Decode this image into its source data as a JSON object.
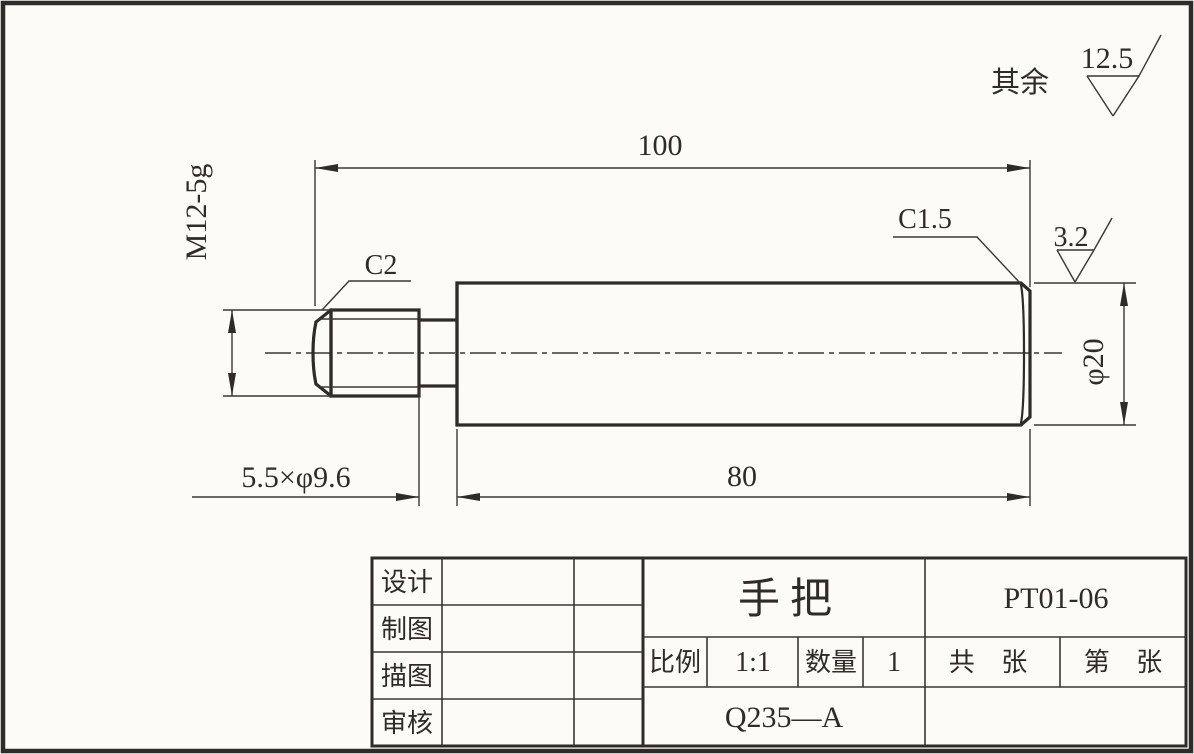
{
  "part": {
    "name": "手把",
    "drawing_number": "PT01-06",
    "material": "Q235—A"
  },
  "surface_note": {
    "prefix": "其余",
    "value": "12.5"
  },
  "dimensions": {
    "overall_length": "100",
    "body_length": "80",
    "thread_spec": "M12-5g",
    "undercut": "5.5×φ9.6",
    "diameter": "φ20",
    "chamfer_thread": "C2",
    "chamfer_end": "C1.5",
    "face_roughness": "3.2"
  },
  "title_block": {
    "row_labels": {
      "design": "设计",
      "drafted": "制图",
      "traced": "描图",
      "checked": "审核"
    },
    "scale_label": "比例",
    "scale_value": "1:1",
    "quantity_label": "数量",
    "quantity_value": "1",
    "total_sheets_label": "共 张",
    "sheet_no_label": "第 张"
  },
  "colors": {
    "line": "#2e2b28",
    "paper": "#fcfbf8"
  }
}
